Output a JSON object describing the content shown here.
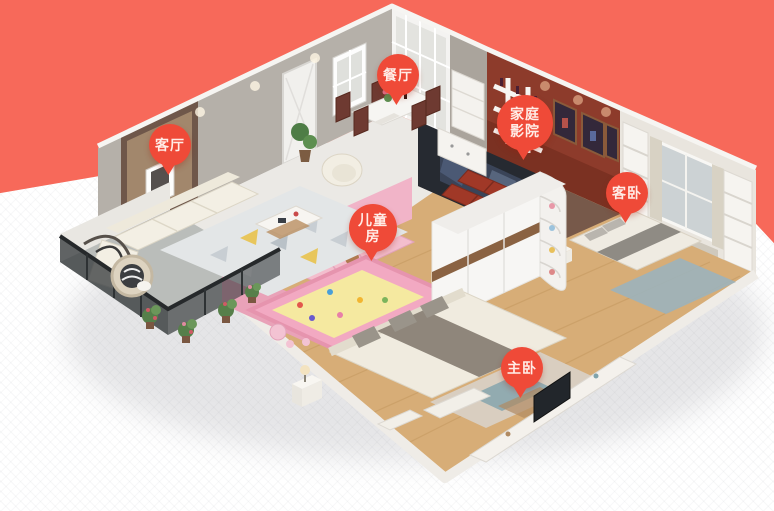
{
  "background": {
    "top_color": "#f7695a",
    "bottom_color": "#ffffff"
  },
  "pin_style": {
    "fill": "#ef4a38",
    "text_color": "#ffece6"
  },
  "pins": {
    "dining": {
      "label": "餐厅"
    },
    "living": {
      "label": "客厅"
    },
    "home_theater": {
      "label": "家庭影院"
    },
    "guest_bedroom": {
      "label": "客卧"
    },
    "kids_room": {
      "label": "儿童房"
    },
    "master_bedroom": {
      "label": "主卧"
    }
  },
  "scene": {
    "description": "isometric 3D cutaway render of an apartment",
    "palette": {
      "back_wall": "#b5b0a9",
      "theater_wall": "#8d3b2b",
      "wood_floor": "#d7ad77",
      "tile_floor": "#ebe9e5",
      "kids_pink": "#f1b4c8",
      "play_mat": "#f5e9a0",
      "sofa_cream": "#f3efe4",
      "theater_sofa": "#a03827",
      "balcony_tile": "#babdba"
    }
  }
}
